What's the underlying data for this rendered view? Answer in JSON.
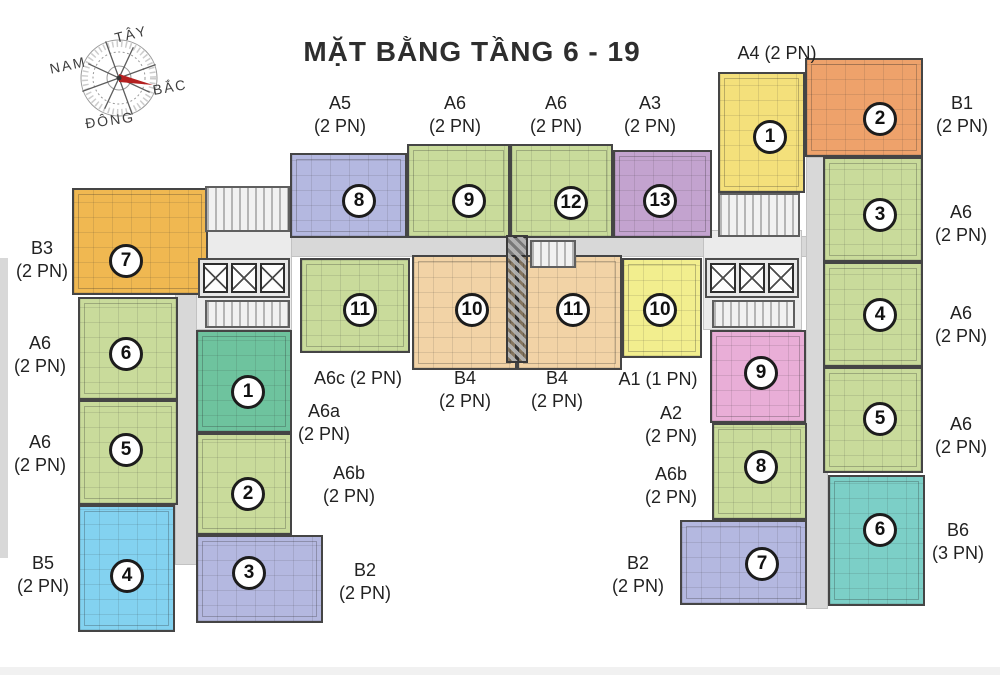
{
  "title": "MẶT BẰNG TẦNG 6 - 19",
  "compass": {
    "west": "TÂY",
    "south": "NAM",
    "north": "BẮC",
    "east": "ĐÔNG"
  },
  "colors": {
    "green": "#c9db9b",
    "teal": "#6ec39e",
    "periwinkle": "#b4b8e0",
    "purple": "#c3a3cf",
    "peach": "#f2d3a6",
    "yellow": "#f4e07b",
    "brightyellow": "#f2ee8e",
    "orange": "#eea26b",
    "gold": "#f0b851",
    "pink": "#e9aed7",
    "cyan": "#83d2f0",
    "aqua": "#7ccfc7",
    "corridor": "#d8d8d8",
    "core": "#ebebeb",
    "bottomstrip": "#f1f1f1"
  },
  "structure": [
    {
      "name": "corridor-horizontal",
      "color": "corridor",
      "rect": [
        175,
        236,
        653,
        21
      ]
    },
    {
      "name": "corridor-left-wing",
      "color": "corridor",
      "rect": [
        175,
        250,
        23,
        315
      ]
    },
    {
      "name": "corridor-right-wing",
      "color": "corridor",
      "rect": [
        806,
        157,
        22,
        452
      ]
    },
    {
      "name": "core-area-left",
      "color": "core",
      "rect": [
        196,
        230,
        96,
        100
      ]
    },
    {
      "name": "core-area-right",
      "color": "core",
      "rect": [
        703,
        230,
        99,
        100
      ]
    },
    {
      "name": "edge-shadow-left",
      "color": "corridor",
      "rect": [
        0,
        258,
        8,
        300
      ],
      "border": false
    },
    {
      "name": "bottom-strip",
      "color": "bottomstrip",
      "rect": [
        0,
        667,
        1000,
        8
      ],
      "border": false
    }
  ],
  "cores": [
    {
      "type": "stairs",
      "rect": [
        205,
        186,
        85,
        46
      ]
    },
    {
      "type": "elevators",
      "rect": [
        198,
        258,
        92,
        40
      ]
    },
    {
      "type": "stairs",
      "rect": [
        205,
        300,
        85,
        28
      ]
    },
    {
      "type": "stairs",
      "rect": [
        718,
        193,
        82,
        44
      ]
    },
    {
      "type": "elevators",
      "rect": [
        705,
        258,
        94,
        40
      ]
    },
    {
      "type": "stairs",
      "rect": [
        712,
        300,
        83,
        28
      ]
    },
    {
      "type": "duct",
      "rect": [
        506,
        235,
        22,
        128
      ]
    },
    {
      "type": "stairs",
      "rect": [
        530,
        240,
        46,
        28
      ]
    }
  ],
  "units": [
    {
      "label": "B3",
      "num": "7",
      "color": "gold",
      "rect": [
        72,
        188,
        136,
        107
      ],
      "circle": [
        124,
        259
      ]
    },
    {
      "label": "A6",
      "num": "6",
      "color": "green",
      "rect": [
        78,
        297,
        100,
        103
      ],
      "circle": [
        124,
        352
      ]
    },
    {
      "label": "A6",
      "num": "5",
      "color": "green",
      "rect": [
        78,
        400,
        100,
        105
      ],
      "circle": [
        124,
        448
      ]
    },
    {
      "label": "B5",
      "num": "4",
      "color": "cyan",
      "rect": [
        78,
        505,
        97,
        127
      ],
      "circle": [
        125,
        574
      ]
    },
    {
      "label": "A6a",
      "num": "1",
      "color": "teal",
      "rect": [
        196,
        330,
        96,
        103
      ],
      "circle": [
        246,
        390
      ]
    },
    {
      "label": "A6b",
      "num": "2",
      "color": "green",
      "rect": [
        196,
        433,
        96,
        102
      ],
      "circle": [
        246,
        492
      ]
    },
    {
      "label": "B2",
      "num": "3",
      "color": "periwinkle",
      "rect": [
        196,
        535,
        127,
        88
      ],
      "circle": [
        247,
        571
      ]
    },
    {
      "label": "A5",
      "num": "8",
      "color": "periwinkle",
      "rect": [
        290,
        153,
        117,
        85
      ],
      "circle": [
        357,
        199
      ]
    },
    {
      "label": "A6",
      "num": "9",
      "color": "green",
      "rect": [
        407,
        144,
        103,
        94
      ],
      "circle": [
        467,
        199
      ]
    },
    {
      "label": "A6",
      "num": "12",
      "color": "green",
      "rect": [
        510,
        144,
        103,
        94
      ],
      "circle": [
        569,
        201
      ]
    },
    {
      "label": "A3",
      "num": "13",
      "color": "purple",
      "rect": [
        613,
        150,
        99,
        88
      ],
      "circle": [
        658,
        199
      ]
    },
    {
      "label": "A4",
      "num": "1",
      "color": "yellow",
      "rect": [
        718,
        72,
        87,
        121
      ],
      "circle": [
        768,
        135
      ]
    },
    {
      "label": "B1",
      "num": "2",
      "color": "orange",
      "rect": [
        805,
        58,
        118,
        99
      ],
      "circle": [
        878,
        117
      ]
    },
    {
      "label": "A6c",
      "num": "11",
      "color": "green",
      "rect": [
        300,
        258,
        110,
        95
      ],
      "circle": [
        358,
        308
      ]
    },
    {
      "label": "B4",
      "num": "10",
      "color": "peach",
      "rect": [
        412,
        255,
        105,
        115
      ],
      "circle": [
        470,
        308
      ]
    },
    {
      "label": "B4",
      "num": "11",
      "color": "peach",
      "rect": [
        517,
        255,
        105,
        115
      ],
      "circle": [
        571,
        308
      ]
    },
    {
      "label": "A1",
      "num": "10",
      "color": "brightyellow",
      "rect": [
        622,
        258,
        80,
        100
      ],
      "circle": [
        658,
        308
      ]
    },
    {
      "label": "A2",
      "num": "9",
      "color": "pink",
      "rect": [
        710,
        330,
        96,
        93
      ],
      "circle": [
        759,
        371
      ]
    },
    {
      "label": "A6b",
      "num": "8",
      "color": "green",
      "rect": [
        712,
        423,
        95,
        97
      ],
      "circle": [
        759,
        465
      ]
    },
    {
      "label": "B2",
      "num": "7",
      "color": "periwinkle",
      "rect": [
        680,
        520,
        127,
        85
      ],
      "circle": [
        760,
        562
      ]
    },
    {
      "label": "A6",
      "num": "3",
      "color": "green",
      "rect": [
        823,
        157,
        100,
        105
      ],
      "circle": [
        878,
        213
      ]
    },
    {
      "label": "A6",
      "num": "4",
      "color": "green",
      "rect": [
        823,
        262,
        100,
        105
      ],
      "circle": [
        878,
        313
      ]
    },
    {
      "label": "A6",
      "num": "5",
      "color": "green",
      "rect": [
        823,
        367,
        100,
        106
      ],
      "circle": [
        878,
        417
      ]
    },
    {
      "label": "B6",
      "num": "6",
      "color": "aqua",
      "rect": [
        828,
        475,
        97,
        131
      ],
      "circle": [
        878,
        528
      ]
    }
  ],
  "unit_labels": [
    {
      "lines": [
        "A5",
        "(2 PN)"
      ],
      "x": 340,
      "y": 92
    },
    {
      "lines": [
        "A6",
        "(2 PN)"
      ],
      "x": 455,
      "y": 92
    },
    {
      "lines": [
        "A6",
        "(2 PN)"
      ],
      "x": 556,
      "y": 92
    },
    {
      "lines": [
        "A3",
        "(2 PN)"
      ],
      "x": 650,
      "y": 92
    },
    {
      "lines": [
        "A4 (2 PN)"
      ],
      "x": 777,
      "y": 42
    },
    {
      "lines": [
        "B1",
        "(2 PN)"
      ],
      "x": 962,
      "y": 92
    },
    {
      "lines": [
        "A6",
        "(2 PN)"
      ],
      "x": 961,
      "y": 201
    },
    {
      "lines": [
        "A6",
        "(2 PN)"
      ],
      "x": 961,
      "y": 302
    },
    {
      "lines": [
        "A6",
        "(2 PN)"
      ],
      "x": 961,
      "y": 413
    },
    {
      "lines": [
        "B6",
        "(3 PN)"
      ],
      "x": 958,
      "y": 519
    },
    {
      "lines": [
        "B3",
        "(2 PN)"
      ],
      "x": 42,
      "y": 237
    },
    {
      "lines": [
        "A6",
        "(2 PN)"
      ],
      "x": 40,
      "y": 332
    },
    {
      "lines": [
        "A6",
        "(2 PN)"
      ],
      "x": 40,
      "y": 431
    },
    {
      "lines": [
        "B5",
        "(2 PN)"
      ],
      "x": 43,
      "y": 552
    },
    {
      "lines": [
        "B2",
        "(2 PN)"
      ],
      "x": 365,
      "y": 559
    },
    {
      "lines": [
        "A6c (2 PN)"
      ],
      "x": 358,
      "y": 367
    },
    {
      "lines": [
        "A6a",
        "(2 PN)"
      ],
      "x": 324,
      "y": 400
    },
    {
      "lines": [
        "A6b",
        "(2 PN)"
      ],
      "x": 349,
      "y": 462
    },
    {
      "lines": [
        "B4",
        "(2 PN)"
      ],
      "x": 465,
      "y": 367
    },
    {
      "lines": [
        "B4",
        "(2 PN)"
      ],
      "x": 557,
      "y": 367
    },
    {
      "lines": [
        "A1 (1 PN)"
      ],
      "x": 658,
      "y": 368
    },
    {
      "lines": [
        "A2",
        "(2 PN)"
      ],
      "x": 671,
      "y": 402
    },
    {
      "lines": [
        "A6b",
        "(2 PN)"
      ],
      "x": 671,
      "y": 463
    },
    {
      "lines": [
        "B2",
        "(2 PN)"
      ],
      "x": 638,
      "y": 552
    }
  ]
}
